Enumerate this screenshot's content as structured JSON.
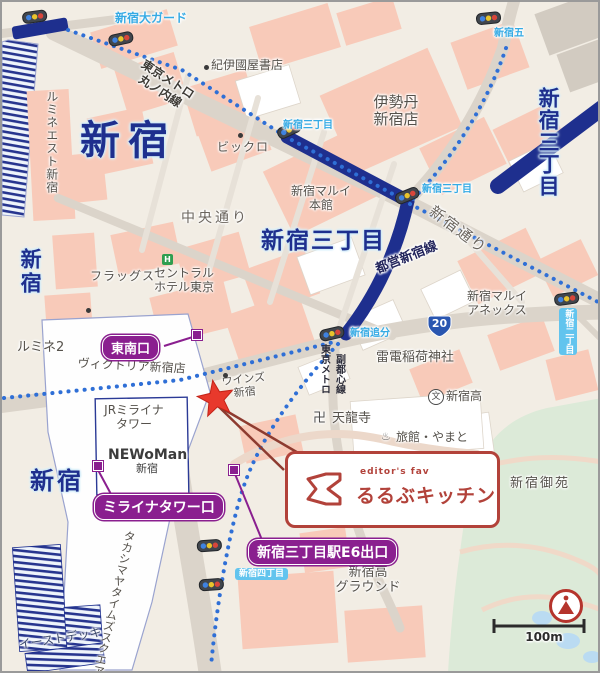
{
  "colors": {
    "background_cream": "#f2ede4",
    "block_salmon": "#f8cab9",
    "road_gray": "#dbd4ca",
    "rail_navy": "#1e2f8e",
    "metro_dot_blue": "#2f6fd6",
    "intersection_blue": "#35aae4",
    "exit_purple": "#8a1f8f",
    "destination_red": "#b2423a",
    "star_red": "#e8392c",
    "park_green": "#dcead8"
  },
  "stations": [
    {
      "name": "shinjuku-northwest",
      "text": "新宿"
    },
    {
      "name": "shinjuku-west-vertical",
      "text": "新宿"
    },
    {
      "name": "shinjuku-south",
      "text": "新宿"
    },
    {
      "name": "shinjuku-sanchome-horizontal",
      "text": "新宿三丁目"
    },
    {
      "name": "shinjuku-sanchome-vertical",
      "text": "新宿三丁目"
    }
  ],
  "intersections": [
    {
      "text": "新宿大ガード"
    },
    {
      "text": "新宿五"
    },
    {
      "text": "新宿三丁目"
    },
    {
      "text": "新宿三丁目"
    },
    {
      "text": "新宿追分"
    },
    {
      "text": "新宿二丁目"
    },
    {
      "text": "新宿四丁目"
    }
  ],
  "rail_lines": [
    {
      "l1": "東京メトロ",
      "l2": "丸ノ内線"
    },
    {
      "text": "都営新宿線"
    },
    {
      "l1": "東京メトロ",
      "l2": "副都心線"
    }
  ],
  "road_names": [
    {
      "text": "中央通り"
    },
    {
      "text": "新宿通り"
    }
  ],
  "places": [
    {
      "name": "lumine-est",
      "text": "ルミネエスト新宿"
    },
    {
      "name": "kinokuniya",
      "text": "紀伊國屋書店"
    },
    {
      "name": "bicqlo",
      "text": "ビックロ"
    },
    {
      "name": "isetan",
      "l1": "伊勢丹",
      "l2": "新宿店"
    },
    {
      "name": "flags",
      "text": "フラッグス"
    },
    {
      "name": "central-hotel-tokyo",
      "l1": "セントラル",
      "l2": "ホテル東京"
    },
    {
      "name": "lumine2",
      "text": "ルミネ2"
    },
    {
      "name": "victoria-shinjuku",
      "text": "ヴィクトリア新宿店"
    },
    {
      "name": "wins-shinjuku",
      "l1": "ウインズ",
      "l2": "新宿"
    },
    {
      "name": "jr-miraina-tower",
      "l1": "JRミライナ",
      "l2": "タワー"
    },
    {
      "name": "newoman-shinjuku",
      "l1": "NEWoMan",
      "l2": "新宿"
    },
    {
      "name": "takashimaya-times-square",
      "text": "タカシマヤタイムズスクエア"
    },
    {
      "name": "east-deck",
      "text": "イーストデッキ"
    },
    {
      "name": "shinjuku-marui-honkan",
      "l1": "新宿マルイ",
      "l2": "本館"
    },
    {
      "name": "shinjuku-marui-annex",
      "l1": "新宿マルイ",
      "l2": "アネックス"
    },
    {
      "name": "raiden-inari-shrine",
      "text": "雷電稲荷神社"
    },
    {
      "name": "shinjuku-high-school",
      "text": "新宿高"
    },
    {
      "name": "shinjuku-gyoen",
      "text": "新宿御苑"
    },
    {
      "name": "shinjuku-high-ground",
      "l1": "新宿高",
      "l2": "グラウンド"
    },
    {
      "name": "ryokan-yamato",
      "text": "旅館・やまと"
    },
    {
      "name": "tenryuji-temple",
      "text": "天龍寺"
    }
  ],
  "badges": [
    {
      "name": "southeast-exit",
      "text": "東南口"
    },
    {
      "name": "miraina-tower-exit",
      "text": "ミライナタワー口"
    },
    {
      "name": "sanchome-e6-exit",
      "text": "新宿三丁目駅E6出口"
    }
  ],
  "callout": {
    "tagline": "editor's fav",
    "title": "るるぶキッチン"
  },
  "icons": {
    "school_glyph": "文",
    "temple_glyph": "卍",
    "onsen_glyph": "♨",
    "hotel_glyph": "H",
    "route20": "20"
  },
  "scale": {
    "label": "100m"
  }
}
